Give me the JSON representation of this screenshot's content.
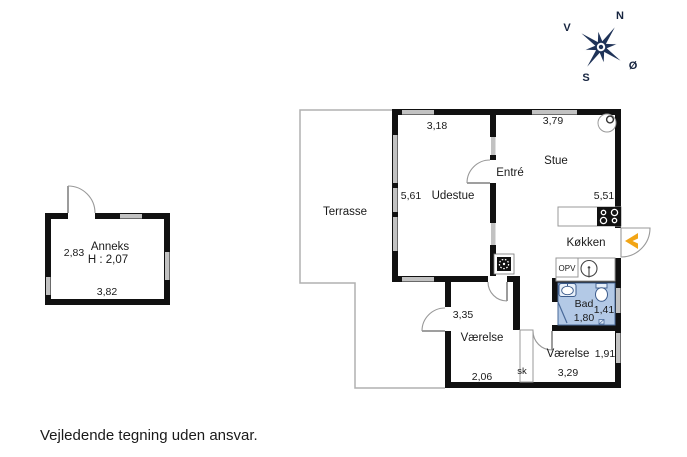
{
  "page": {
    "background": "#ffffff"
  },
  "footer": {
    "disclaimer": "Vejledende tegning uden ansvar."
  },
  "compass": {
    "north": "N",
    "south": "S",
    "east": "Ø",
    "west": "V"
  },
  "colors": {
    "wall": "#111111",
    "window": "#c2c2c2",
    "terrace_line": "#b0b0b0",
    "door_line": "#888888",
    "bath_fill": "#b3c9e6",
    "bath_line": "#4a6a99",
    "entrance_arrow": "#f2a516",
    "compass_star": "#1f3358"
  },
  "anneks": {
    "name": "Anneks",
    "ceiling_height": "H : 2,07",
    "depth": "2,83",
    "width": "3,82"
  },
  "main_house": {
    "terrasse": {
      "name": "Terrasse"
    },
    "udestue": {
      "name": "Udestue",
      "depth": "5,61",
      "width": "3,18"
    },
    "entre": {
      "name": "Entré"
    },
    "stue": {
      "name": "Stue",
      "width": "3,79",
      "depth": "5,51"
    },
    "kokken": {
      "name": "Køkken"
    },
    "opv": {
      "label": "OPV"
    },
    "bad": {
      "name": "Bad",
      "width": "1,41",
      "depth": "1,80"
    },
    "vaerelse_left": {
      "name": "Værelse",
      "depth": "3,35",
      "width": "2,06"
    },
    "vaerelse_right": {
      "name": "Værelse",
      "depth": "1,91",
      "width": "3,29"
    },
    "skab": {
      "label": "sk"
    }
  }
}
